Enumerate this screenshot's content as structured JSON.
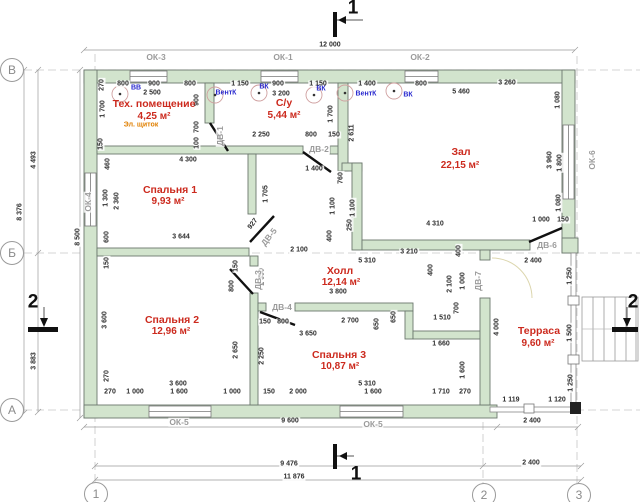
{
  "drawing": {
    "rooms": [
      {
        "name": "Тех. помещение",
        "area": "4,25 м²",
        "nx": 154,
        "ny": 104,
        "ax": 154,
        "ay": 117
      },
      {
        "name": "С/у",
        "area": "5,44 м²",
        "nx": 284,
        "ny": 103,
        "ax": 284,
        "ay": 116
      },
      {
        "name": "Зал",
        "area": "22,15 м²",
        "nx": 461,
        "ny": 152,
        "ax": 460,
        "ay": 166
      },
      {
        "name": "Спальня 1",
        "area": "9,93 м²",
        "nx": 170,
        "ny": 190,
        "ax": 168,
        "ay": 202
      },
      {
        "name": "Спальня 2",
        "area": "12,96 м²",
        "nx": 172,
        "ny": 320,
        "ax": 171,
        "ay": 332
      },
      {
        "name": "Холл",
        "area": "12,14 м²",
        "nx": 340,
        "ny": 271,
        "ax": 341,
        "ay": 283
      },
      {
        "name": "Спальня 3",
        "area": "10,87 м²",
        "nx": 339,
        "ny": 355,
        "ax": 340,
        "ay": 367
      },
      {
        "name": "Терраса",
        "area": "9,60 м²",
        "nx": 539,
        "ny": 331,
        "ax": 538,
        "ay": 344
      }
    ],
    "windows": [
      {
        "label": "ОК-3",
        "x": 156,
        "y": 57
      },
      {
        "label": "ОК-1",
        "x": 283,
        "y": 57
      },
      {
        "label": "ОК-2",
        "x": 420,
        "y": 57
      },
      {
        "label": "ОК-4",
        "x": 88,
        "y": 202,
        "r": -90
      },
      {
        "label": "ОК-6",
        "x": 592,
        "y": 160,
        "r": -90
      },
      {
        "label": "ОК-5",
        "x": 179,
        "y": 422
      },
      {
        "label": "ОК-5",
        "x": 373,
        "y": 424
      }
    ],
    "doors": [
      {
        "label": "ДВ-1",
        "x": 220,
        "y": 136,
        "r": -90
      },
      {
        "label": "ДВ-2",
        "x": 319,
        "y": 149
      },
      {
        "label": "ДВ-3",
        "x": 258,
        "y": 280,
        "r": -90
      },
      {
        "label": "ДВ-4",
        "x": 282,
        "y": 307
      },
      {
        "label": "ДВ-5",
        "x": 269,
        "y": 237,
        "r": -52
      },
      {
        "label": "ДВ-6",
        "x": 547,
        "y": 245
      },
      {
        "label": "ДВ-7",
        "x": 478,
        "y": 281,
        "r": -90
      }
    ],
    "vent_labels": [
      {
        "text": "ВВ",
        "x": 136,
        "y": 88
      },
      {
        "text": "ВентК",
        "x": 226,
        "y": 93
      },
      {
        "text": "ВК",
        "x": 264,
        "y": 87
      },
      {
        "text": "ВК",
        "x": 321,
        "y": 89
      },
      {
        "text": "ВентК",
        "x": 366,
        "y": 94
      },
      {
        "text": "ВК",
        "x": 408,
        "y": 95
      }
    ],
    "electrical_labels": [
      {
        "text": "Эл. щиток",
        "x": 141,
        "y": 125
      }
    ],
    "axis_markers": {
      "rows": [
        {
          "label": "В",
          "x": 12,
          "y": 70
        },
        {
          "label": "Б",
          "x": 12,
          "y": 253
        },
        {
          "label": "А",
          "x": 12,
          "y": 410
        }
      ],
      "cols": [
        {
          "label": "1",
          "x": 96,
          "y": 494
        },
        {
          "label": "2",
          "x": 484,
          "y": 495
        },
        {
          "label": "3",
          "x": 579,
          "y": 495
        }
      ]
    },
    "section_markers": [
      {
        "label": "1",
        "x": 353,
        "y": 8
      },
      {
        "label": "1",
        "x": 356,
        "y": 474
      },
      {
        "label": "2",
        "x": 33,
        "y": 302
      },
      {
        "label": "2",
        "x": 633,
        "y": 302
      }
    ],
    "dimensions": [
      {
        "text": "12 000",
        "x": 330,
        "y": 45
      },
      {
        "text": "800",
        "x": 123,
        "y": 84
      },
      {
        "text": "900",
        "x": 154,
        "y": 84
      },
      {
        "text": "800",
        "x": 190,
        "y": 84
      },
      {
        "text": "1 150",
        "x": 240,
        "y": 84
      },
      {
        "text": "900",
        "x": 278,
        "y": 84
      },
      {
        "text": "1 150",
        "x": 318,
        "y": 84
      },
      {
        "text": "1 400",
        "x": 367,
        "y": 84
      },
      {
        "text": "800",
        "x": 421,
        "y": 84
      },
      {
        "text": "3 260",
        "x": 507,
        "y": 83
      },
      {
        "text": "2 500",
        "x": 152,
        "y": 93
      },
      {
        "text": "3 200",
        "x": 281,
        "y": 94
      },
      {
        "text": "5 460",
        "x": 461,
        "y": 92
      },
      {
        "text": "4 493",
        "x": 34,
        "y": 160,
        "r": -90
      },
      {
        "text": "8 376",
        "x": 20,
        "y": 212,
        "r": -90
      },
      {
        "text": "8 500",
        "x": 78,
        "y": 237,
        "r": -90
      },
      {
        "text": "3 883",
        "x": 34,
        "y": 361,
        "r": -90
      },
      {
        "text": "270",
        "x": 102,
        "y": 85,
        "r": -90
      },
      {
        "text": "1 700",
        "x": 103,
        "y": 109,
        "r": -90
      },
      {
        "text": "150",
        "x": 101,
        "y": 144,
        "r": -90
      },
      {
        "text": "460",
        "x": 108,
        "y": 164,
        "r": -90
      },
      {
        "text": "1 300",
        "x": 106,
        "y": 198,
        "r": -90
      },
      {
        "text": "2 360",
        "x": 117,
        "y": 201,
        "r": -90
      },
      {
        "text": "600",
        "x": 107,
        "y": 237,
        "r": -90
      },
      {
        "text": "150",
        "x": 107,
        "y": 263,
        "r": -90
      },
      {
        "text": "3 600",
        "x": 105,
        "y": 320,
        "r": -90
      },
      {
        "text": "270",
        "x": 107,
        "y": 376,
        "r": -90
      },
      {
        "text": "900",
        "x": 197,
        "y": 100,
        "r": -90
      },
      {
        "text": "700",
        "x": 197,
        "y": 127,
        "r": -90
      },
      {
        "text": "100",
        "x": 197,
        "y": 143,
        "r": -90
      },
      {
        "text": "4 300",
        "x": 188,
        "y": 160
      },
      {
        "text": "1 705",
        "x": 266,
        "y": 194,
        "r": -90
      },
      {
        "text": "3 644",
        "x": 181,
        "y": 237
      },
      {
        "text": "927",
        "x": 253,
        "y": 224,
        "r": -52
      },
      {
        "text": "2 250",
        "x": 261,
        "y": 135
      },
      {
        "text": "800",
        "x": 311,
        "y": 135
      },
      {
        "text": "150",
        "x": 334,
        "y": 135
      },
      {
        "text": "1 700",
        "x": 331,
        "y": 114,
        "r": -90
      },
      {
        "text": "2 611",
        "x": 352,
        "y": 133,
        "r": -90
      },
      {
        "text": "1 400",
        "x": 314,
        "y": 169
      },
      {
        "text": "760",
        "x": 341,
        "y": 178,
        "r": -90
      },
      {
        "text": "1 100",
        "x": 333,
        "y": 206,
        "r": -90
      },
      {
        "text": "1 100",
        "x": 353,
        "y": 208,
        "r": -90
      },
      {
        "text": "250",
        "x": 350,
        "y": 225,
        "r": -90
      },
      {
        "text": "400",
        "x": 330,
        "y": 236,
        "r": -90
      },
      {
        "text": "4 310",
        "x": 435,
        "y": 224
      },
      {
        "text": "1 000",
        "x": 541,
        "y": 220
      },
      {
        "text": "150",
        "x": 563,
        "y": 220
      },
      {
        "text": "1 080",
        "x": 558,
        "y": 100,
        "r": -90
      },
      {
        "text": "3 960",
        "x": 550,
        "y": 160,
        "r": -90
      },
      {
        "text": "1 800",
        "x": 560,
        "y": 163,
        "r": -90
      },
      {
        "text": "1 080",
        "x": 559,
        "y": 203,
        "r": -90
      },
      {
        "text": "2 100",
        "x": 299,
        "y": 250
      },
      {
        "text": "3 210",
        "x": 409,
        "y": 252
      },
      {
        "text": "5 310",
        "x": 367,
        "y": 261
      },
      {
        "text": "400",
        "x": 431,
        "y": 270,
        "r": -90
      },
      {
        "text": "400",
        "x": 459,
        "y": 251,
        "r": -90
      },
      {
        "text": "2 100",
        "x": 450,
        "y": 284,
        "r": -90
      },
      {
        "text": "1 000",
        "x": 463,
        "y": 281,
        "r": -90
      },
      {
        "text": "700",
        "x": 457,
        "y": 308,
        "r": -90
      },
      {
        "text": "3 800",
        "x": 338,
        "y": 292
      },
      {
        "text": "150",
        "x": 265,
        "y": 322
      },
      {
        "text": "800",
        "x": 283,
        "y": 322
      },
      {
        "text": "2 700",
        "x": 350,
        "y": 321
      },
      {
        "text": "3 650",
        "x": 308,
        "y": 334
      },
      {
        "text": "650",
        "x": 377,
        "y": 324,
        "r": -90
      },
      {
        "text": "650",
        "x": 394,
        "y": 317,
        "r": -90
      },
      {
        "text": "1 510",
        "x": 442,
        "y": 318
      },
      {
        "text": "1 660",
        "x": 441,
        "y": 344
      },
      {
        "text": "1 600",
        "x": 463,
        "y": 370,
        "r": -90
      },
      {
        "text": "4 000",
        "x": 497,
        "y": 327,
        "r": -90
      },
      {
        "text": "2 400",
        "x": 533,
        "y": 261
      },
      {
        "text": "1 250",
        "x": 570,
        "y": 276,
        "r": -90
      },
      {
        "text": "1 500",
        "x": 570,
        "y": 333,
        "r": -90
      },
      {
        "text": "1 250",
        "x": 571,
        "y": 383,
        "r": -90
      },
      {
        "text": "1 119",
        "x": 511,
        "y": 400
      },
      {
        "text": "1 120",
        "x": 557,
        "y": 400
      },
      {
        "text": "2 400",
        "x": 532,
        "y": 421
      },
      {
        "text": "2 400",
        "x": 531,
        "y": 463
      },
      {
        "text": "9 600",
        "x": 290,
        "y": 421
      },
      {
        "text": "9 476",
        "x": 289,
        "y": 464
      },
      {
        "text": "11 876",
        "x": 294,
        "y": 477
      },
      {
        "text": "150",
        "x": 236,
        "y": 266,
        "r": -90
      },
      {
        "text": "800",
        "x": 232,
        "y": 286,
        "r": -90
      },
      {
        "text": "1 350",
        "x": 262,
        "y": 277,
        "r": -90
      },
      {
        "text": "2 650",
        "x": 236,
        "y": 350,
        "r": -90
      },
      {
        "text": "2 250",
        "x": 262,
        "y": 356,
        "r": -90
      },
      {
        "text": "3 600",
        "x": 178,
        "y": 384
      },
      {
        "text": "270",
        "x": 110,
        "y": 392
      },
      {
        "text": "1 000",
        "x": 135,
        "y": 392
      },
      {
        "text": "1 600",
        "x": 179,
        "y": 392
      },
      {
        "text": "1 000",
        "x": 232,
        "y": 392
      },
      {
        "text": "150",
        "x": 269,
        "y": 392
      },
      {
        "text": "2 000",
        "x": 298,
        "y": 392
      },
      {
        "text": "5 310",
        "x": 367,
        "y": 384
      },
      {
        "text": "1 600",
        "x": 373,
        "y": 392
      },
      {
        "text": "1 710",
        "x": 441,
        "y": 392
      },
      {
        "text": "270",
        "x": 465,
        "y": 392
      }
    ]
  },
  "colors": {
    "wall_fill": "#d2e4cd",
    "wall_stroke": "#6b776d",
    "room_label": "#cc2a1e",
    "vent_label": "#2929cf",
    "electrical_label": "#e07f00",
    "opening_label": "#9b9b9b",
    "dimension_text": "#2e2e2e",
    "axis_text": "#8a8a8a"
  }
}
